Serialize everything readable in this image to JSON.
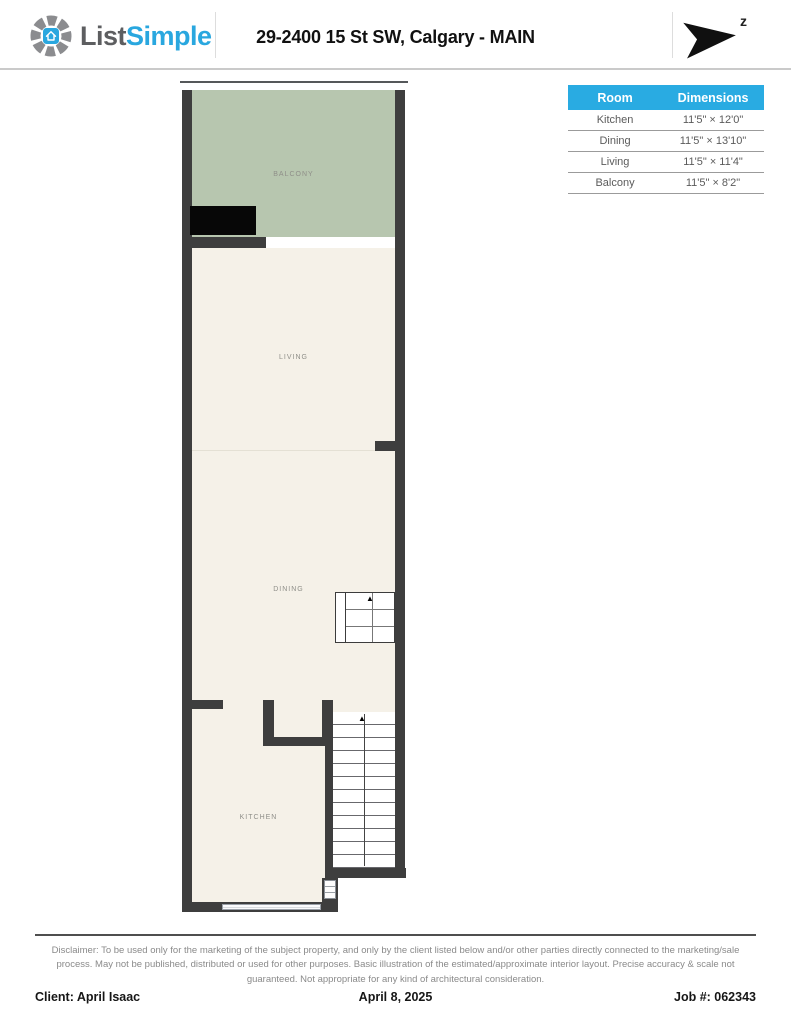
{
  "header": {
    "logo": {
      "text_primary": "List",
      "text_secondary": "Simple"
    },
    "title": "29-2400 15 St SW, Calgary - MAIN",
    "compass": {
      "label": "z"
    }
  },
  "dimensions_table": {
    "header": {
      "room": "Room",
      "dimensions": "Dimensions"
    },
    "header_bg": "#29abe2",
    "rows": [
      {
        "room": "Kitchen",
        "dimensions": "11'5\" × 12'0\""
      },
      {
        "room": "Dining",
        "dimensions": "11'5\" × 13'10\""
      },
      {
        "room": "Living",
        "dimensions": "11'5\" × 11'4\""
      },
      {
        "room": "Balcony",
        "dimensions": "11'5\" × 8'2\""
      }
    ]
  },
  "floor_plan": {
    "labels": {
      "balcony": "BALCONY",
      "living": "LIVING",
      "dining": "DINING",
      "kitchen": "KITCHEN"
    },
    "colors": {
      "wall": "#3e3e3e",
      "balcony_fill": "#b7c6af",
      "floor_fill": "#f5f1e8"
    },
    "stair_arrow": "▲"
  },
  "disclaimer": "Disclaimer: To be used only for the marketing of the subject property, and only by the client listed below and/or other parties directly connected to the marketing/sale process. May not be published, distributed or used for other purposes. Basic illustration of the estimated/approximate interior layout. Precise accuracy & scale not guaranteed. Not appropriate for any kind of architectural consideration.",
  "footer": {
    "client": "Client: April Isaac",
    "date": "April 8, 2025",
    "job_number": "Job #: 062343"
  }
}
